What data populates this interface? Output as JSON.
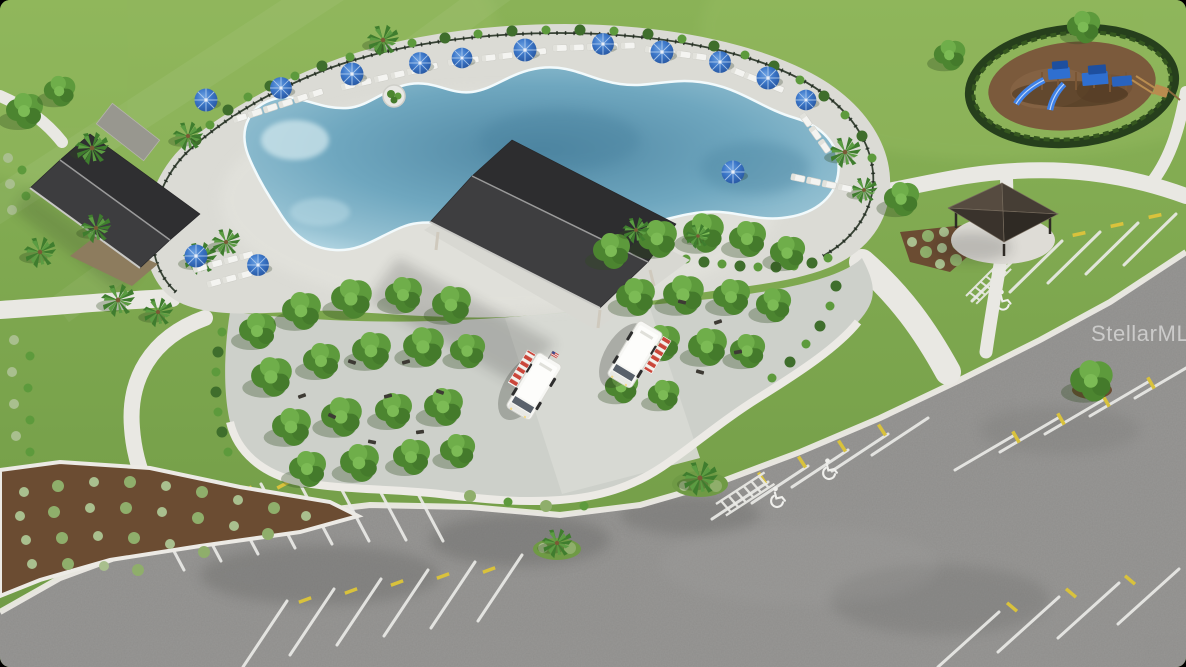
{
  "photo": {
    "type": "aerial 3D architectural rendering",
    "subject": "Community amenity center: free-form pool with blue umbrellas and white loungers, clubhouse, open-air event pavilion, food trucks, shaded tree plaza, picnic gazebo, hedge-ringed playground and striped parking lot",
    "watermark": "StellarMLS"
  },
  "watermark": {
    "text": "StellarMLS",
    "color": "rgba(255,255,255,0.52)"
  },
  "palette": {
    "grass": "#7ea950",
    "asphalt": "#8f8e8c",
    "concrete_path": "#e9e8e3",
    "pool_deck": "#dbdbd5",
    "plaza_pavers": "#cdd0ca",
    "pool_water": "#6fa7bf",
    "roof_charcoal": "#38383a",
    "gazebo_roof": "#4a4138",
    "umbrella_blue": "#2f6cc0",
    "playground_blue": "#2f6fd0",
    "mulch": "#7b5a3e",
    "stripe_white": "#ebebe7",
    "wheel_stop_yellow": "#d9c23c",
    "truck_awning_red": "#ca463a",
    "truck_body": "#f7f7f4"
  },
  "features": [
    {
      "name": "free-form-pool",
      "label": "Free-form resort pool"
    },
    {
      "name": "pool-deck",
      "label": "Pool deck with lounge chairs and umbrellas",
      "umbrellas": 14
    },
    {
      "name": "clubhouse",
      "label": "Clubhouse with charcoal roof"
    },
    {
      "name": "event-pavilion",
      "label": "Open-air event pavilion"
    },
    {
      "name": "tree-grove-plaza",
      "label": "Paved plaza with shade trees and benches"
    },
    {
      "name": "food-trucks",
      "label": "Food trucks with striped awnings",
      "count": 2
    },
    {
      "name": "playground",
      "label": "Hedge-ringed playground with blue play structure"
    },
    {
      "name": "gazebo",
      "label": "Picnic gazebo"
    },
    {
      "name": "parking-lot",
      "label": "Striped parking lot with accessible spaces",
      "accessible_symbols": 3
    },
    {
      "name": "walking-paths",
      "label": "Curved concrete walking paths"
    }
  ]
}
